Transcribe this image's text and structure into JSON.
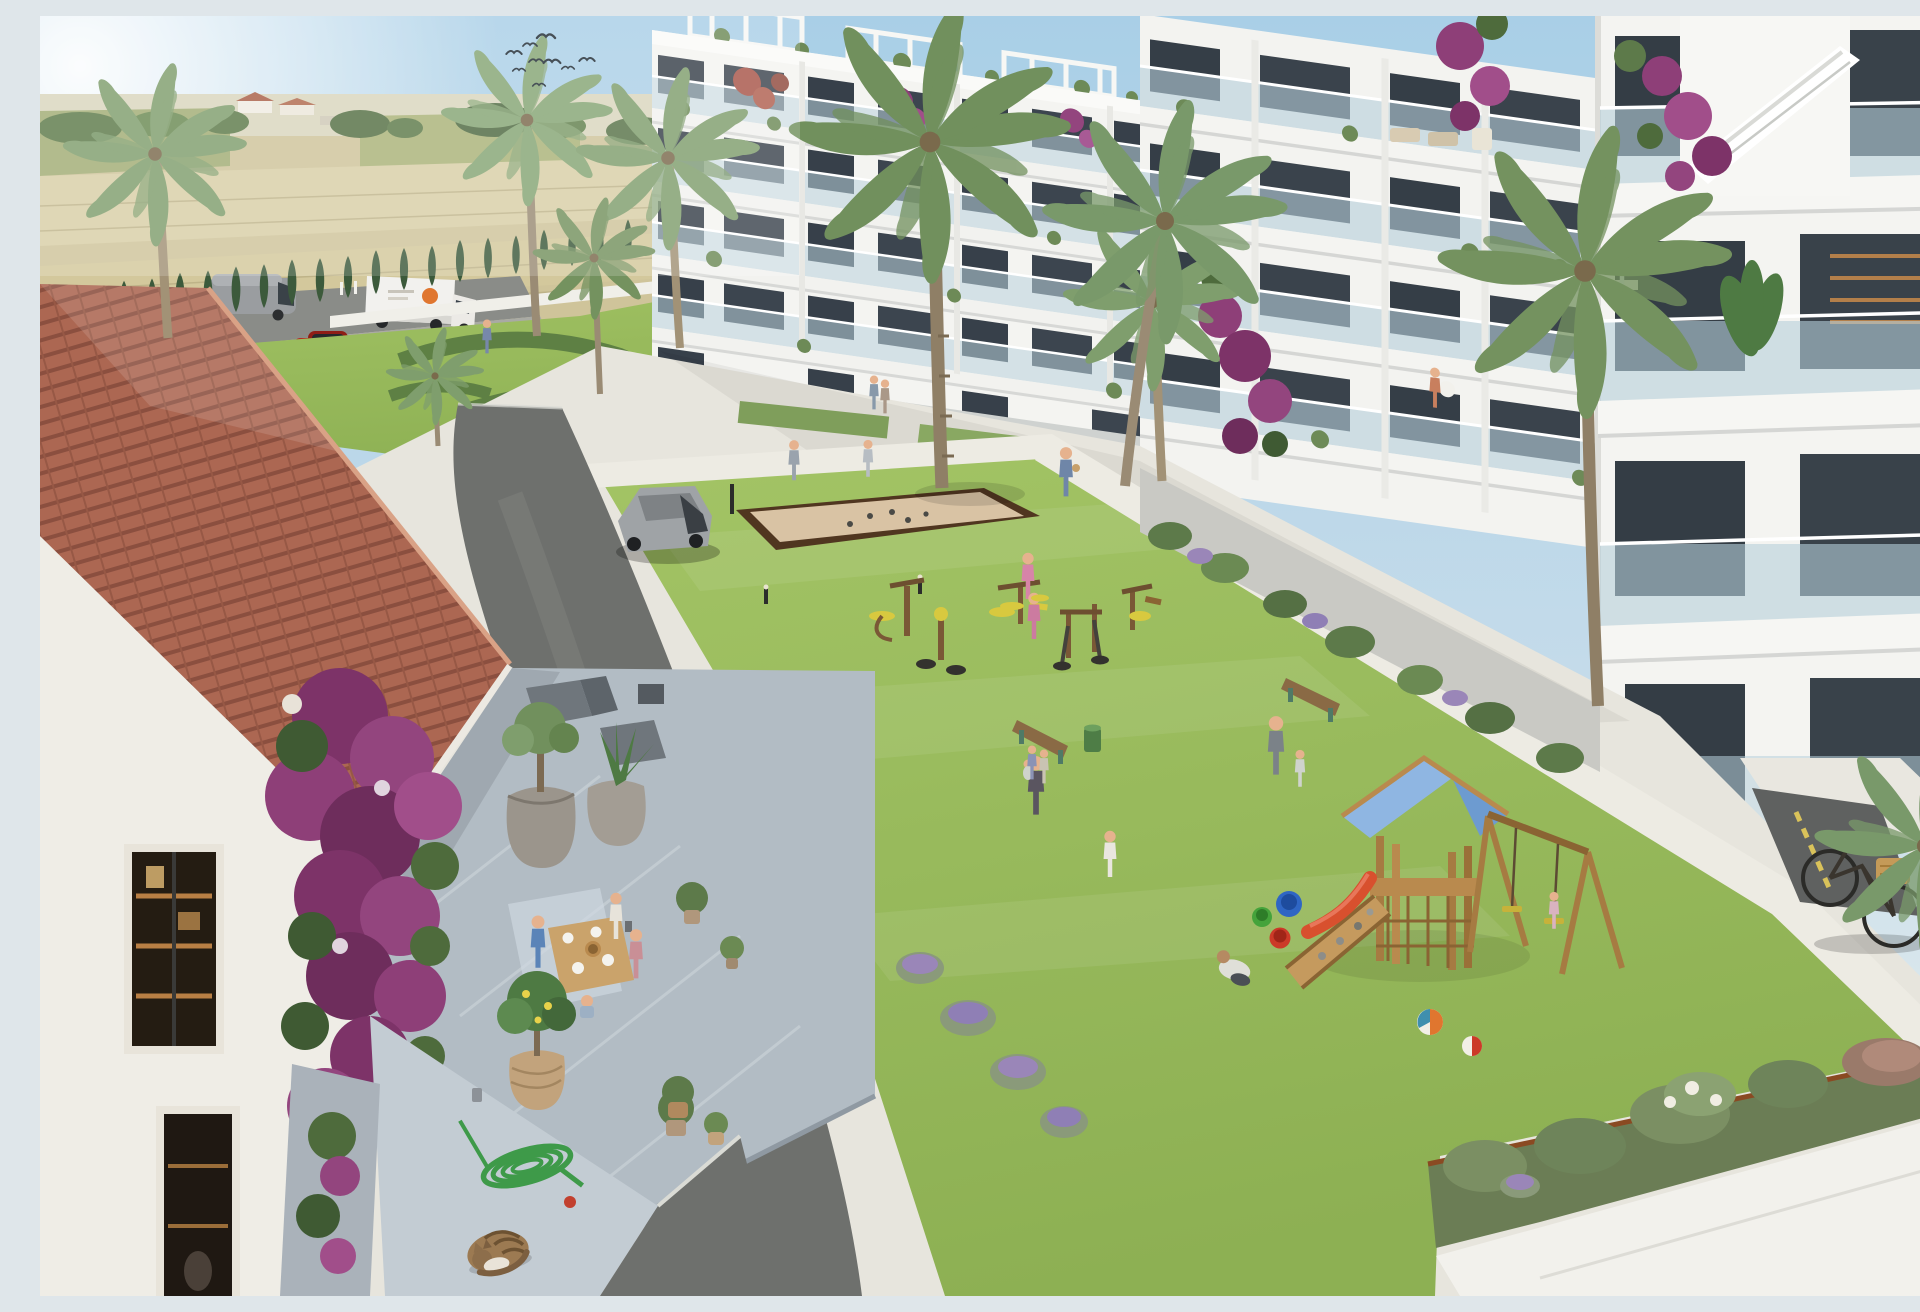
{
  "scene": {
    "setting": "Aerial 3D architectural rendering of a modern white apartment complex with landscaped courtyard, pool and playground beside open farm fields",
    "time_of_day": "sunny midday, hazy sunlight from upper left",
    "sky": {
      "birds": 9,
      "sun_glare": "top-left"
    },
    "background": {
      "fields": "harvested wheat fields with tree line",
      "farmhouse": "small red-roofed farm buildings on horizon",
      "highway_vehicles": [
        "grey panel van",
        "white box truck with orange logo",
        "red parked car"
      ],
      "cypress_hedge": "row of columnar cypresses along the boundary"
    },
    "left_building": {
      "floors": 5,
      "style": "white block, glass balconies, rooftop pergolas, bougainvillea"
    },
    "right_building": {
      "floors": 5,
      "style": "white stepped balconies, glass railings, potted plants, external stair tower"
    },
    "amenities": [
      "swimming pool",
      "ornamental hedge garden",
      "petanque court",
      "outdoor gym",
      "children playground",
      "benches",
      "central lawn"
    ],
    "playground": {
      "tower_roof": "light blue",
      "slide": "red",
      "swings": 2,
      "buckets": [
        "blue",
        "red",
        "green"
      ],
      "beach_balls": 2,
      "climbing_ramp": "wood with stones"
    },
    "foreground": {
      "house": "terracotta barrel-tile roof over white walls",
      "terrace": "grey marble terrace with family dining table, lounge chairs, stone planters",
      "plants": [
        "bougainvillea",
        "olive tree",
        "agave",
        "lemon tree",
        "lavender"
      ],
      "hose": "green coiled garden hose with red nozzle",
      "cat": "tabby cat curled asleep on the tiles"
    },
    "vehicles_inside": [
      "silver SUV on internal road",
      "black city bicycle with wicker basket"
    ],
    "people_count": 26
  },
  "labels": {
    "canvas": "architectural rendering",
    "sky": "hazy blue sky with sun glare",
    "birds": "flock of swallows",
    "fields": "wheat fields and tree line",
    "highway": "road with van, truck and red car",
    "garden_upper": "pool garden with hedges and cypresses",
    "pool": "turquoise swimming pool",
    "left_building": "apartment block A",
    "right_building": "apartment block B",
    "courtyard": "central courtyard with lawn and paths",
    "road": "internal asphalt road",
    "suv": "silver SUV",
    "petanque": "sand petanque court",
    "gym": "outdoor fitness equipment",
    "playground": "wooden playground with blue roof",
    "right_garden": "planted border, ramp and bicycle",
    "bicycle": "bicycle with basket",
    "house": "tiled-roof house with dining terrace",
    "cat": "sleeping tabby cat",
    "hose": "coiled garden hose",
    "palms": "palm trees"
  },
  "palette": {
    "sky_top": "#aed2e8",
    "sky_horizon": "#eef2ef",
    "field_tan": "#cfc49a",
    "field_light": "#dcd3ab",
    "tree_green": "#5d7a4a",
    "cypress": "#3c5a3b",
    "palm_frond": "#7f9e6d",
    "palm_trunk": "#a29276",
    "building_white": "#f4f4f1",
    "slab_shadow": "#d9dbdc",
    "glass": "#afccda",
    "window_dark": "#343d45",
    "roof_tile": "#b56e58",
    "roof_rib": "#8e5242",
    "lawn": "#9cbd5e",
    "lawn_dark": "#86a94f",
    "path": "#edebe3",
    "asphalt": "#6e706d",
    "terrace_grey": "#b2bcc4",
    "pool_water": "#45bcd6",
    "sand": "#d9c3a4",
    "sand_border": "#503620",
    "wood": "#b98a4e",
    "play_roof_blue": "#82add8",
    "bougainvillea": "#8e3f78",
    "lavender": "#9a86b8",
    "accent_red": "#d8502e",
    "bucket_blue": "#2f66c4",
    "bucket_red": "#cc3a28",
    "bucket_green": "#45a33b",
    "car_red": "#b5271f",
    "logo_orange": "#e0762f"
  }
}
